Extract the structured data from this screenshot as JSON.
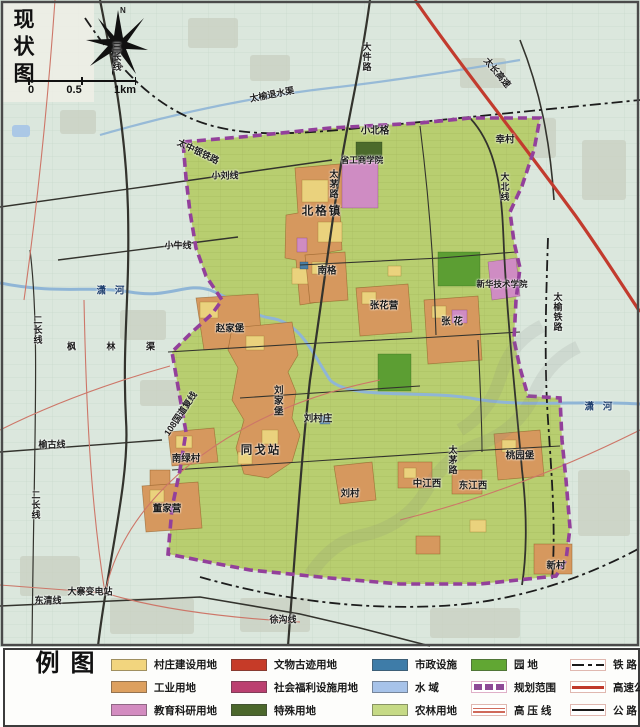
{
  "map": {
    "title": "现状图",
    "compass_label": "N",
    "scale": [
      "0",
      "0.5",
      "1km"
    ],
    "labels": [
      {
        "t": "三长线",
        "x": 116,
        "y": 57,
        "o": "v",
        "k": "road"
      },
      {
        "t": "大件路",
        "x": 366,
        "y": 57,
        "o": "v",
        "k": "road"
      },
      {
        "t": "太长高速",
        "x": 497,
        "y": 73,
        "rot": 50,
        "k": "road"
      },
      {
        "t": "太榆退水渠",
        "x": 272,
        "y": 95,
        "rot": -11,
        "k": "road"
      },
      {
        "t": "小北格",
        "x": 375,
        "y": 131,
        "k": "place"
      },
      {
        "t": "幸村",
        "x": 505,
        "y": 140,
        "k": "place"
      },
      {
        "t": "太中银铁路",
        "x": 198,
        "y": 152,
        "rot": 26,
        "k": "road"
      },
      {
        "t": "省工商学院",
        "x": 362,
        "y": 160,
        "k": "college"
      },
      {
        "t": "小刘线",
        "x": 225,
        "y": 176,
        "k": "road"
      },
      {
        "t": "太茅路",
        "x": 333,
        "y": 184,
        "o": "v",
        "k": "road"
      },
      {
        "t": "大北线",
        "x": 504,
        "y": 187,
        "o": "v",
        "k": "road"
      },
      {
        "t": "北格镇",
        "x": 322,
        "y": 212,
        "k": "town"
      },
      {
        "t": "小牛线",
        "x": 178,
        "y": 246,
        "k": "road"
      },
      {
        "t": "南格",
        "x": 327,
        "y": 271,
        "k": "place"
      },
      {
        "t": "新华技术学院",
        "x": 502,
        "y": 284,
        "k": "college"
      },
      {
        "t": "潇 河",
        "x": 112,
        "y": 291,
        "k": "river"
      },
      {
        "t": "张花营",
        "x": 384,
        "y": 306,
        "k": "place"
      },
      {
        "t": "张 花",
        "x": 452,
        "y": 322,
        "k": "place"
      },
      {
        "t": "太榆铁路",
        "x": 557,
        "y": 312,
        "o": "v",
        "k": "road"
      },
      {
        "t": "二长线",
        "x": 37,
        "y": 330,
        "o": "v",
        "k": "road"
      },
      {
        "t": "枫 林 渠",
        "x": 118,
        "y": 347,
        "k": "road",
        "wide": true
      },
      {
        "t": "赵家堡",
        "x": 230,
        "y": 329,
        "k": "place"
      },
      {
        "t": "刘家堡",
        "x": 277,
        "y": 401,
        "o": "v",
        "k": "place"
      },
      {
        "t": "108国道复线",
        "x": 181,
        "y": 414,
        "rot": -56,
        "k": "road"
      },
      {
        "t": "刘村庄",
        "x": 318,
        "y": 419,
        "k": "place"
      },
      {
        "t": "榆古线",
        "x": 52,
        "y": 445,
        "k": "road"
      },
      {
        "t": "同戈站",
        "x": 261,
        "y": 451,
        "k": "town"
      },
      {
        "t": "桃园堡",
        "x": 520,
        "y": 456,
        "k": "place"
      },
      {
        "t": "太茅路",
        "x": 452,
        "y": 460,
        "o": "v",
        "k": "road"
      },
      {
        "t": "南绿村",
        "x": 186,
        "y": 459,
        "k": "place"
      },
      {
        "t": "中江西",
        "x": 427,
        "y": 484,
        "k": "place"
      },
      {
        "t": "东江西",
        "x": 473,
        "y": 486,
        "k": "place"
      },
      {
        "t": "刘村",
        "x": 350,
        "y": 494,
        "k": "place"
      },
      {
        "t": "二长线",
        "x": 35,
        "y": 505,
        "o": "v",
        "k": "road"
      },
      {
        "t": "董家营",
        "x": 167,
        "y": 509,
        "k": "place"
      },
      {
        "t": "新村",
        "x": 556,
        "y": 566,
        "k": "place"
      },
      {
        "t": "大寨变电站",
        "x": 90,
        "y": 592,
        "k": "road"
      },
      {
        "t": "东清线",
        "x": 48,
        "y": 601,
        "k": "road"
      },
      {
        "t": "潇 河",
        "x": 600,
        "y": 407,
        "k": "river"
      },
      {
        "t": "徐沟线",
        "x": 283,
        "y": 620,
        "k": "road"
      }
    ]
  },
  "legend": {
    "title": "图例",
    "items": [
      {
        "label": "村庄建设用地",
        "color": "#f2d57e",
        "kind": "fill"
      },
      {
        "label": "工业用地",
        "color": "#dda05f",
        "kind": "fill"
      },
      {
        "label": "教育科研用地",
        "color": "#d38cc0",
        "kind": "fill"
      },
      {
        "label": "文物古迹用地",
        "color": "#c63b28",
        "kind": "fill"
      },
      {
        "label": "社会福利设施用地",
        "color": "#bb4070",
        "kind": "fill"
      },
      {
        "label": "特殊用地",
        "color": "#4c682c",
        "kind": "fill"
      },
      {
        "label": "市政设施",
        "color": "#3e7ca8",
        "kind": "fill"
      },
      {
        "label": "水 域",
        "color": "#a7c3e9",
        "kind": "fill"
      },
      {
        "label": "农林用地",
        "color": "#c6da85",
        "kind": "fill"
      },
      {
        "label": "园 地",
        "color": "#61a733",
        "kind": "fill"
      },
      {
        "label": "规划范围",
        "color": "#8e4a96",
        "kind": "dashed-blocks"
      },
      {
        "label": "高 压 线",
        "color": "#d06a5a",
        "kind": "double-line"
      },
      {
        "label": "铁 路",
        "color": "#1a1a1a",
        "kind": "rail-line"
      },
      {
        "label": "高速公路",
        "color": "#c0392b",
        "kind": "red-line"
      },
      {
        "label": "公 路",
        "color": "#1a1a1a",
        "kind": "black-line"
      }
    ]
  },
  "colors": {
    "outside": "#dbe7dd",
    "farm": "#b8ce70",
    "farmline": "#9cb254",
    "industrial": "#d6985e",
    "village": "#ead27d",
    "education": "#cf8cc3",
    "garden": "#5c9e33",
    "special": "#4b6a2b",
    "municipal": "#4a7fa6",
    "water": "#8fb5d6",
    "boundary": "#93409b",
    "road": "#33332d",
    "railway": "#1c1c1c",
    "highway": "#c23b2e",
    "hvline": "#cd7668",
    "built": "#c8cfc0"
  }
}
